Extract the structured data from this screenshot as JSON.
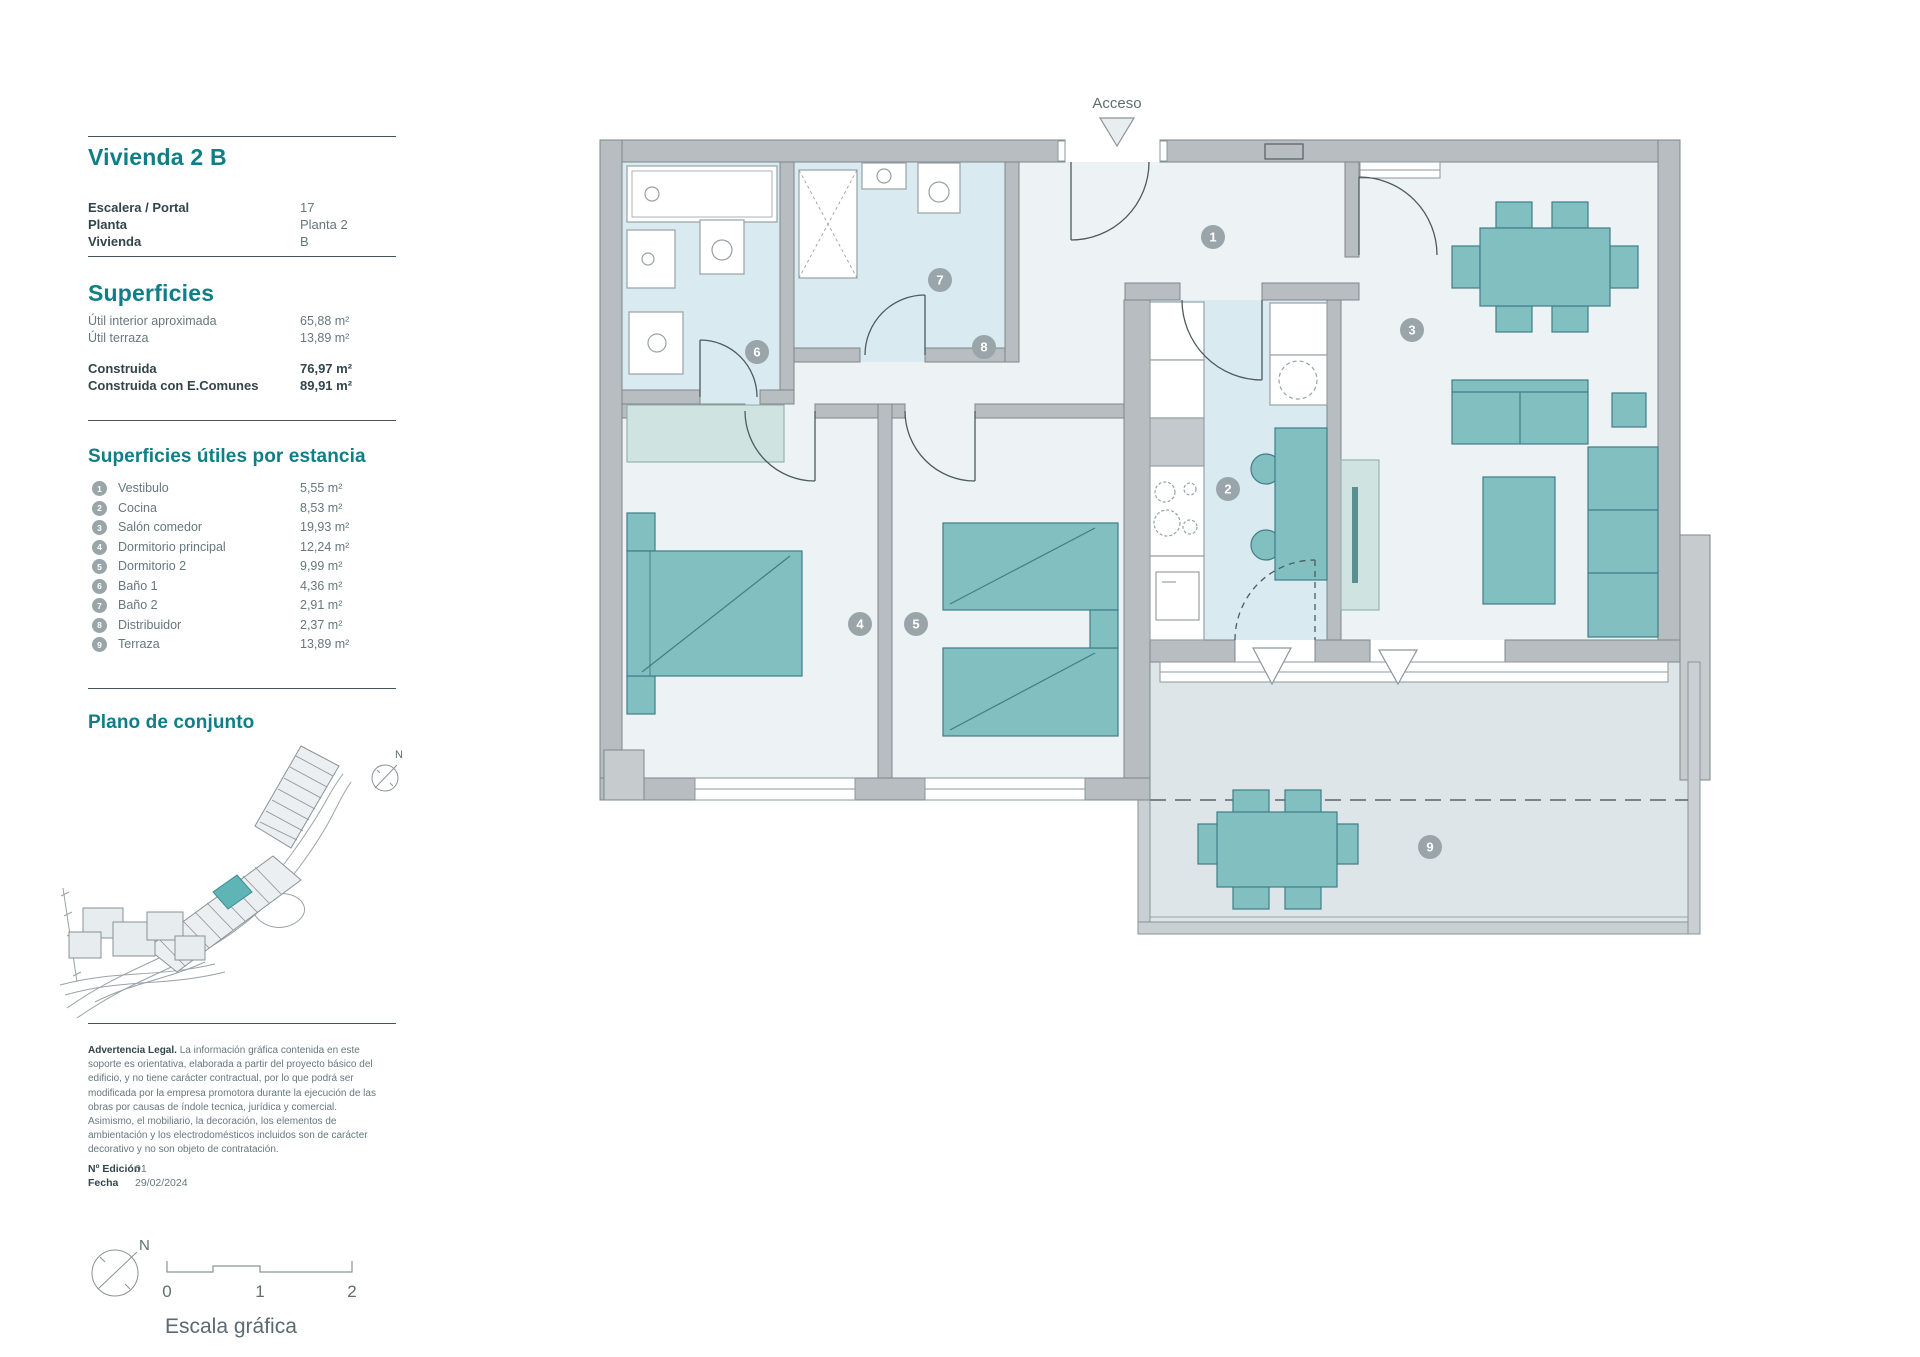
{
  "colors": {
    "accent": "#0e7e87",
    "wall_grey": "#b7bdc0",
    "furniture_teal": "#81bfc1",
    "wet_floor_blue": "#d9ebf1",
    "terrace_floor": "#dee5e8",
    "badge_grey": "#9aa5a9"
  },
  "panel": {
    "title": "Vivienda 2 B",
    "info": [
      {
        "label": "Escalera / Portal",
        "value": "17"
      },
      {
        "label": "Planta",
        "value": "Planta 2"
      },
      {
        "label": "Vivienda",
        "value": "B"
      }
    ],
    "superficies": {
      "heading": "Superficies",
      "rows": [
        {
          "label": "Útil interior aproximada",
          "value": "65,88 m²"
        },
        {
          "label": "Útil terraza",
          "value": "13,89 m²"
        }
      ],
      "totals": [
        {
          "label": "Construida",
          "value": "76,97 m²"
        },
        {
          "label": "Construida con E.Comunes",
          "value": "89,91 m²"
        }
      ]
    },
    "estancias": {
      "heading": "Superficies útiles por estancia",
      "rows": [
        {
          "num": "1",
          "label": "Vestibulo",
          "value": "5,55 m²"
        },
        {
          "num": "2",
          "label": "Cocina",
          "value": "8,53 m²"
        },
        {
          "num": "3",
          "label": "Salón comedor",
          "value": "19,93 m²"
        },
        {
          "num": "4",
          "label": "Dormitorio principal",
          "value": "12,24 m²"
        },
        {
          "num": "5",
          "label": "Dormitorio 2",
          "value": "9,99 m²"
        },
        {
          "num": "6",
          "label": "Baño 1",
          "value": "4,36 m²"
        },
        {
          "num": "7",
          "label": "Baño 2",
          "value": "2,91 m²"
        },
        {
          "num": "8",
          "label": "Distribuidor",
          "value": "2,37 m²"
        },
        {
          "num": "9",
          "label": "Terraza",
          "value": "13,89 m²"
        }
      ]
    },
    "site_plan": {
      "heading": "Plano de conjunto",
      "north": "N"
    },
    "legal": {
      "title": "Advertencia Legal.",
      "body": " La información gráfica contenida en este soporte es orientativa, elaborada a partir del proyecto básico del edificio, y no tiene carácter contractual, por lo que podrá ser modificada por la empresa promotora durante la ejecución de las obras por causas de índole tecnica, jurídica y comercial. Asimismo, el mobiliario, la decoración, los elementos de ambientación y los electrodomésticos incluidos son de carácter decorativo y no son objeto de contratación."
    },
    "edition": [
      {
        "label": "Nº Edición",
        "value": "01"
      },
      {
        "label": "Fecha",
        "value": "29/02/2024"
      }
    ],
    "scale": {
      "north": "N",
      "marks": [
        "0",
        "1",
        "2"
      ],
      "caption": "Escala gráfica"
    }
  },
  "plan": {
    "access_label": "Acceso",
    "badges": [
      "1",
      "2",
      "3",
      "4",
      "5",
      "6",
      "7",
      "8",
      "9"
    ]
  }
}
